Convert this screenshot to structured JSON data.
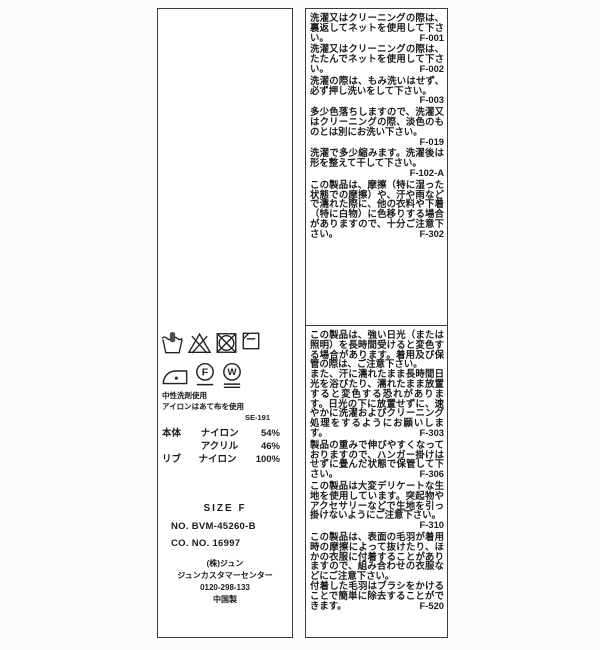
{
  "left_label": {
    "care_symbols": [
      {
        "name": "hand-wash-icon"
      },
      {
        "name": "do-not-bleach-icon"
      },
      {
        "name": "do-not-tumble-dry-icon"
      },
      {
        "name": "flat-dry-in-shade-icon"
      },
      {
        "name": "iron-low-heat-icon"
      },
      {
        "name": "dry-clean-petroleum-icon",
        "letter": "F"
      },
      {
        "name": "wet-clean-very-gentle-icon",
        "letter": "W"
      }
    ],
    "notes": {
      "line1": "中性洗剤使用",
      "line2": "アイロンはあて布を使用"
    },
    "label_code": "SE-191",
    "composition": [
      {
        "part": "本体",
        "material": "ナイロン",
        "percent": "54%"
      },
      {
        "part": "",
        "material": "アクリル",
        "percent": "46%"
      },
      {
        "part": "リブ",
        "material": "ナイロン",
        "percent": "100%"
      }
    ],
    "size": "SIZE F",
    "product_no": "NO. BVM-45260-B",
    "co_no": "CO. NO. 16997",
    "company": "(株)ジュン",
    "customer_center": "ジュンカスタマーセンター",
    "phone": "0120-298-133",
    "origin": "中国製"
  },
  "right_label": {
    "top_instructions": [
      {
        "text": "洗濯又はクリーニングの際は、裏返してネットを使用して下さい。",
        "code": "F-001"
      },
      {
        "text": "洗濯又はクリーニングの際は、たたんでネットを使用して下さい。",
        "code": "F-002"
      },
      {
        "text": "洗濯の際は、もみ洗いはせず、必ず押し洗いをして下さい。",
        "code": "F-003"
      },
      {
        "text": "多少色落ちしますので、洗濯又はクリーニングの際、淡色のものとは別にお洗い下さい。",
        "code": "F-019"
      },
      {
        "text": "洗濯で多少縮みます。洗濯後は形を整えて干して下さい。",
        "code": "F-102-A"
      },
      {
        "text": "この製品は、摩擦（特に湿った状態での摩擦）や、汗や雨などで濡れた際に、他の衣料や下着（特に白物）に色移りする場合がありますので、十分ご注意下さい。",
        "code": "F-302"
      }
    ],
    "bottom_instructions": [
      {
        "text": "この製品は、強い日光（または照明）を長時間受けると変色する場合があります。着用及び保管の際は、ご注意下さい。\nまた、汗に濡れたまま長時間日光を浴びたり、濡れたまま放置すると変色する恐れがあります。日光の下に放置せずに、速やかに洗濯およびクリーニング処理をするようにお願いします。",
        "code": "F-303"
      },
      {
        "text": "製品の重みで伸びやすくなっておりますので、ハンガー掛けはせずに畳んだ状態で保管して下さい。",
        "code": "F-306"
      },
      {
        "text": "この製品は大変デリケートな生地を使用しています。突起物やアクセサリーなどで生地を引っ掛けないようにご注意下さい。",
        "code": "F-310"
      },
      {
        "text": "この製品は、表面の毛羽が着用時の摩擦によって抜けたり、ほかの衣服に付着することがありますので、組み合わせの衣服などにご注意下さい。\n付着した毛羽はブラシをかけることで簡単に除去することができます。",
        "code": "F-520"
      }
    ]
  }
}
